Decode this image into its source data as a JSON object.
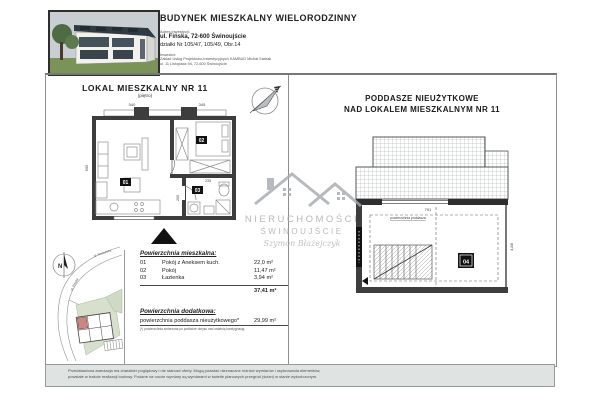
{
  "header": {
    "title": "BUDYNEK MIESZKALNY WIELORODZINNY",
    "address_label": "Adres inwestycji:",
    "address_line1": "ul. Fińska, 72-600 Świnoujście",
    "address_line2": "działki Nr 105/47, 105/49, Obr.14",
    "investor_label": "Inwestor:",
    "investor_line1": "Zakład Usług Projektowo-Inwestycyjnych KAMBUD Michał Sarbak",
    "investor_line2": "ul. 11 Listopada 94, 72-600 Świnoujście"
  },
  "left_panel": {
    "title": "LOKAL MIESZKALNY NR 11",
    "subtitle": "(piętro)"
  },
  "left_plan": {
    "rooms": {
      "r1": "01",
      "r2": "02",
      "r3": "03"
    },
    "dims": {
      "w1": "540",
      "w2": "345",
      "h1": "605",
      "b1": "235",
      "b2": "200"
    }
  },
  "right_panel": {
    "title_line1": "PODDASZE NIEUŻYTKOWE",
    "title_line2": "NAD LOKALEM MIESZKALNYM NR 11"
  },
  "attic": {
    "room_label": "04",
    "note": "powierzchnia poddasza",
    "dims": {
      "w": "791",
      "h": "4,88"
    }
  },
  "watermark": {
    "brand_line1": "NIERUCHOMOŚCI",
    "brand_line2": "ŚWINOUJŚCIE",
    "signature": "Szymon Błażejczyk"
  },
  "site_plan": {
    "north": "N",
    "street_finska": "ul. Fińska",
    "street_norweska": "ul. Norweska"
  },
  "areas": {
    "section_living_title": "Powierzchnia mieszkalna:",
    "rows": [
      {
        "no": "01",
        "name": "Pokój z Aneksem kuch.",
        "area": "22,0 m²"
      },
      {
        "no": "02",
        "name": "Pokój",
        "area": "11,47 m²"
      },
      {
        "no": "03",
        "name": "Łazienka",
        "area": "3,94 m²"
      }
    ],
    "total": "37,41 m²",
    "section_additional_title": "Powierzchnia dodatkowa:",
    "additional_name": "powierzchnia poddasza nieużytkowego*",
    "additional_area": "29,99 m²",
    "footnote": "(*) powierzchnia zmierzona po podłodze obrysu nad ostatnią kondygnacją."
  },
  "footer": {
    "line1": "Przedstawiona aranżacja ma charakter poglądowy i nie stanowi oferty. Mogą powstać nieznaczne różnice wymiarów i usytuowania elementów,",
    "line2": "powstałe w trakcie realizacji budowy. Podane na rzucie wymiary są wymiarami w świetle planowych przegród (ścian) w stanie wykończonym."
  },
  "colors": {
    "wall": "#3d3d3d",
    "footer_bar": "#dfe3e1",
    "watermark_gray": "#a4a9ae",
    "highlight_unit_red": "#c98884",
    "greenery": "#d7e0cd"
  }
}
